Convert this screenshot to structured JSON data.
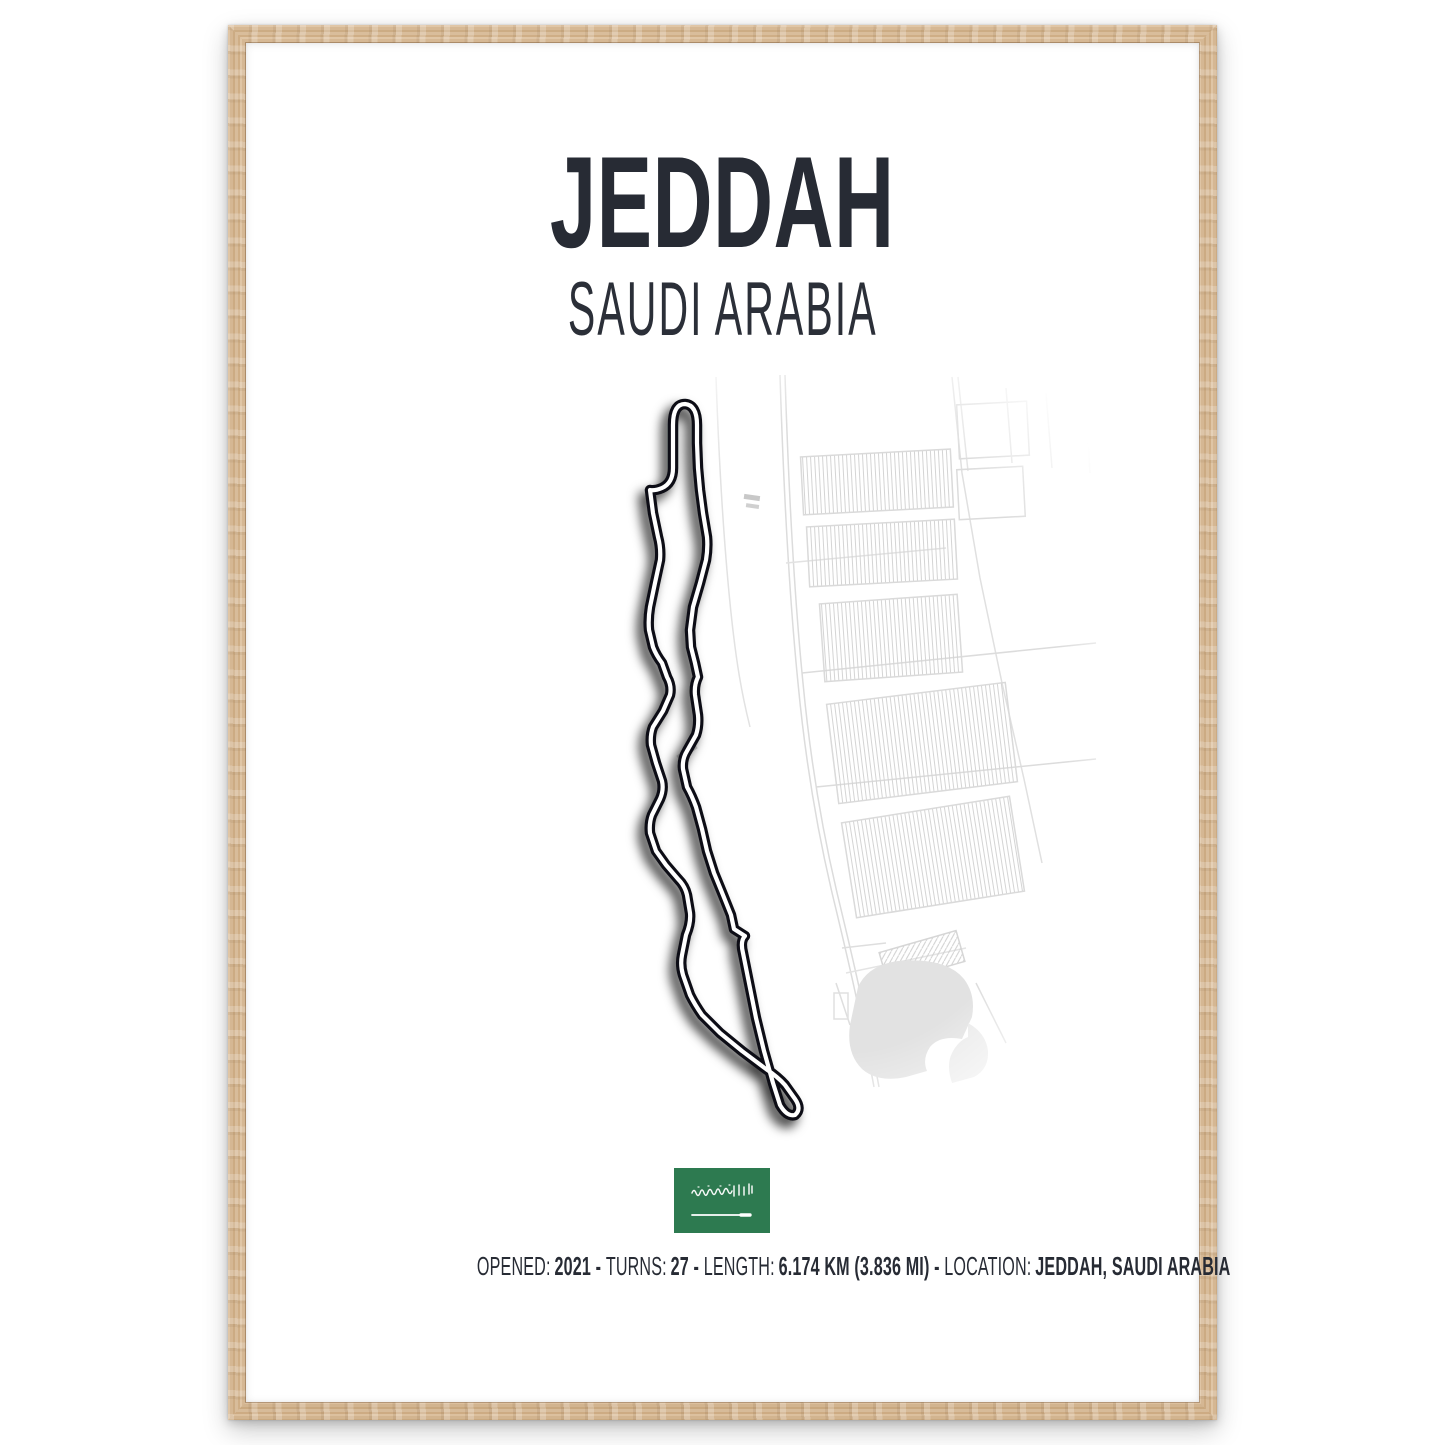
{
  "poster": {
    "title": "JEDDAH",
    "subtitle": "SAUDI ARABIA",
    "stats": {
      "separator": " - ",
      "items": [
        {
          "label": "OPENED:",
          "value": "2021"
        },
        {
          "label": "TURNS:",
          "value": "27"
        },
        {
          "label": "LENGTH:",
          "value": "6.174 KM (3.836 MI)"
        },
        {
          "label": "LOCATION:",
          "value": "JEDDAH, SAUDI ARABIA"
        }
      ]
    },
    "flag": {
      "country": "Saudi Arabia",
      "inscription": "لا إله إلا الله محمد رسول الله",
      "green": "#2d7a50"
    },
    "colors": {
      "ink": "#272b34",
      "frame_wood": "#d4b793",
      "track": "#0d0f13",
      "map_lines": "#dcdcdc"
    }
  }
}
